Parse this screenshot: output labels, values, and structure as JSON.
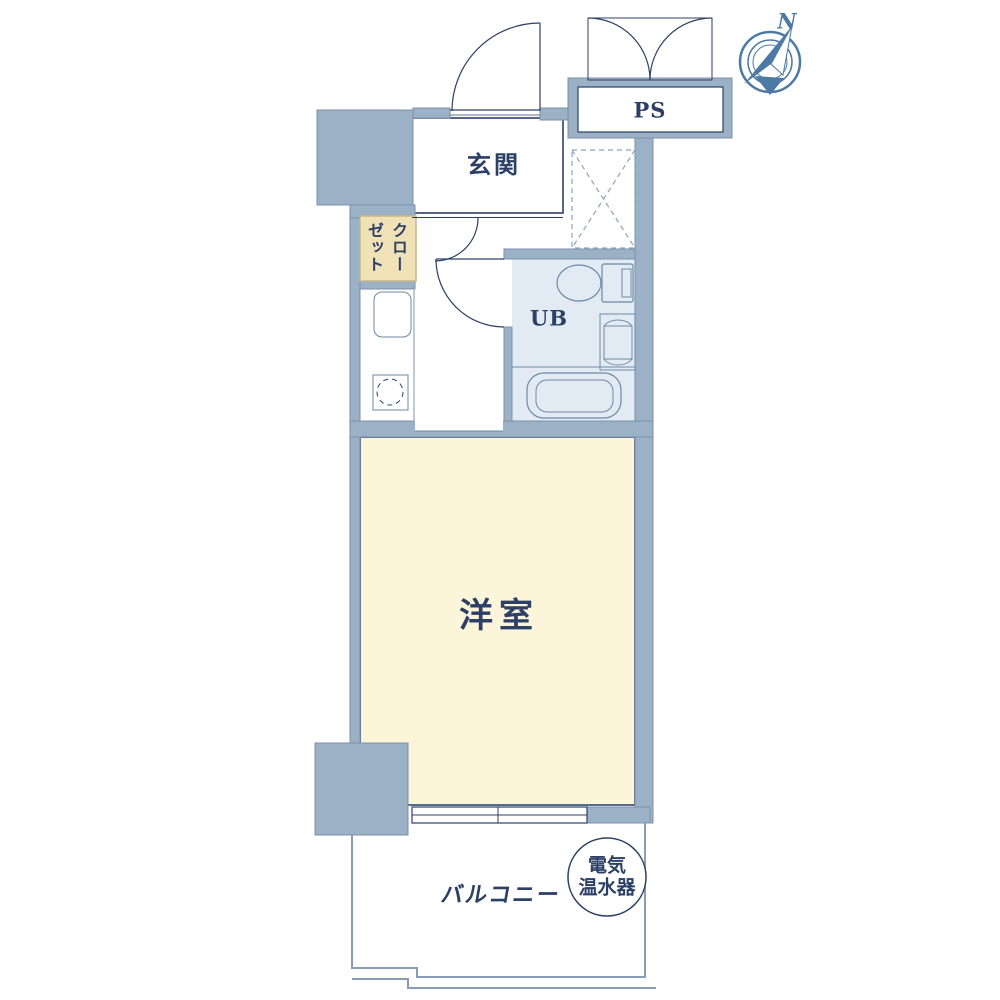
{
  "labels": {
    "genkan": "玄関",
    "ps": "PS",
    "closet": "クローゼット",
    "closet_col_right": "クロー",
    "closet_col_left": "ゼット",
    "unit_bath": "UB",
    "western_room": "洋室",
    "balcony": "バルコニー",
    "water_heater": "電気温水器",
    "water_heater_line1": "電気",
    "water_heater_line2": "温水器",
    "compass_north": "N"
  },
  "colors": {
    "wall_fill": "#9ab1c6",
    "wall_stroke": "#7e91a8",
    "line_dark": "#2c4066",
    "room_border": "#566c8c",
    "room_fill": "#fdf5da",
    "bath_fill": "#e2ebf3",
    "closet_fill": "#f0e2b6",
    "closet_stroke": "#c9b688",
    "fixture_stroke": "#6e88a5",
    "balcony_stroke": "#8a9cb2",
    "compass_color": "#4c7aa4",
    "dashed_box_stroke": "#8aa3c0"
  }
}
